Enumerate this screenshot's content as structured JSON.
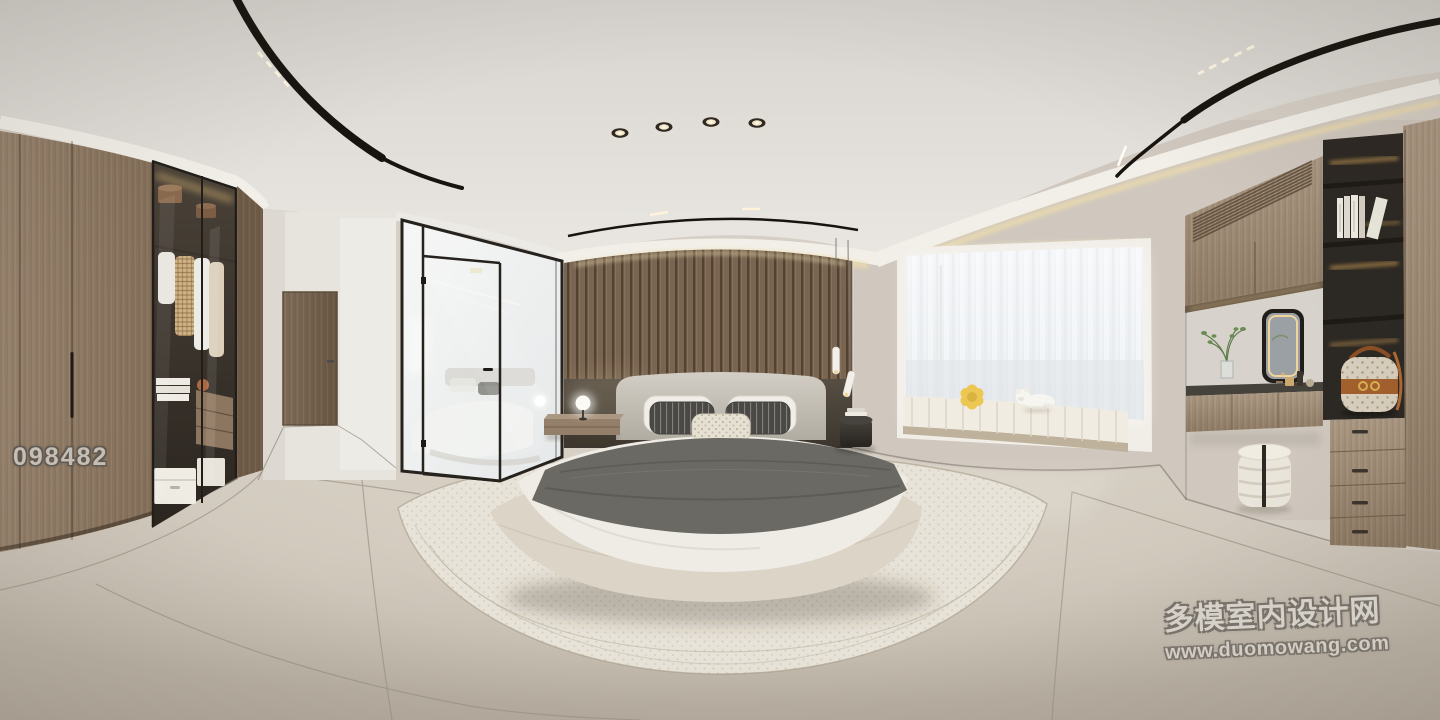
{
  "meta": {
    "description": "360-degree equirectangular panorama render of a modern minimalist bedroom",
    "render_width": 1440,
    "render_height": 720
  },
  "watermarks": {
    "photo_id": "098482",
    "site_name": "多模室内设计网",
    "site_url": "www.duomowang.com"
  },
  "palette": {
    "ceiling": "#dcd9d4",
    "wall": "#d6cfc6",
    "floor": "#c4bbae",
    "wood_light": "#a8957e",
    "wood_dark": "#7d6a55",
    "slat_wall": "#84705a",
    "headboard_panel": "#4f4840",
    "bedding_white": "#efece5",
    "blanket_gray": "#6b6963",
    "rug": "#e7e2d7",
    "window_glow": "#f4f5f6",
    "cove_light": "#eedcab",
    "track_light_black": "#17140f",
    "glass_frame_black": "#26221e",
    "bag_leather": "#a2602c"
  },
  "scene": {
    "room": "bedroom",
    "objects": [
      "curved-led-track-lights",
      "recessed-downlights",
      "cove-lighting",
      "wardrobe",
      "glass-display-cabinet",
      "hanging-clothes",
      "storage-boxes",
      "hallway",
      "entry-door",
      "glass-partition-wall",
      "glass-door",
      "wood-slat-accent-wall",
      "upholstered-bed",
      "gray-throw-blanket",
      "floating-nightstand",
      "sphere-table-lamp",
      "pendant-lights",
      "black-side-table",
      "round-area-rug",
      "bay-window",
      "sheer-curtains",
      "window-seat-cushion",
      "flower-pillow",
      "teddy-bear",
      "vanity-desk",
      "led-mirror",
      "potted-plant",
      "cosmetics",
      "drum-stool",
      "open-shelving",
      "books",
      "handbag",
      "drawer-chest"
    ]
  }
}
